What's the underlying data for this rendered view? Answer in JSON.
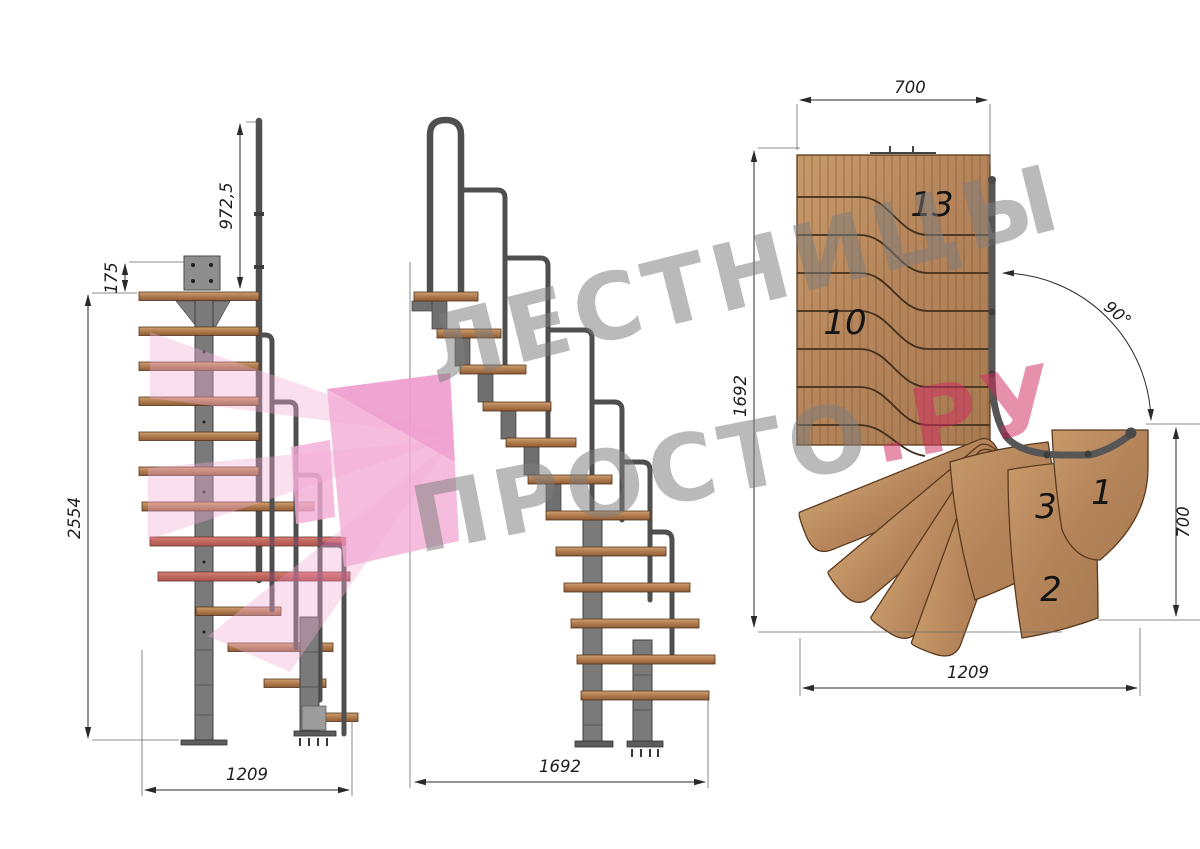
{
  "drawing": {
    "views": {
      "side": {
        "label": "side-elevation",
        "dims": {
          "rail_height": "972,5",
          "top_offset": "175",
          "total_height": "2554",
          "width": "1209"
        }
      },
      "front": {
        "label": "front-elevation",
        "dims": {
          "width": "1692"
        }
      },
      "plan": {
        "label": "plan-view",
        "dims": {
          "top_width": "700",
          "left_height": "1692",
          "turn_angle": "90°",
          "right_depth": "700",
          "bottom_width": "1209"
        },
        "step_numbers": [
          "13",
          "10",
          "3",
          "1",
          "2"
        ]
      }
    },
    "watermark": {
      "line1": "ЛЕСТНИЦЫ",
      "line2_gray": "ПРОСТО",
      "line2_accent": ".РУ"
    },
    "colors": {
      "background": "#ffffff",
      "wood": "#bd8f63",
      "wood_edge": "#5a3a1e",
      "step_board": "#b37e50",
      "metal": "#7a7a7a",
      "metal_dark": "#454545",
      "handrail": "#4f4f4f",
      "dimension": "#2a2a2a",
      "watermark_gray": "#7d7d7d",
      "watermark_pink": "#f3abd5",
      "watermark_accent": "#d12b61"
    }
  }
}
